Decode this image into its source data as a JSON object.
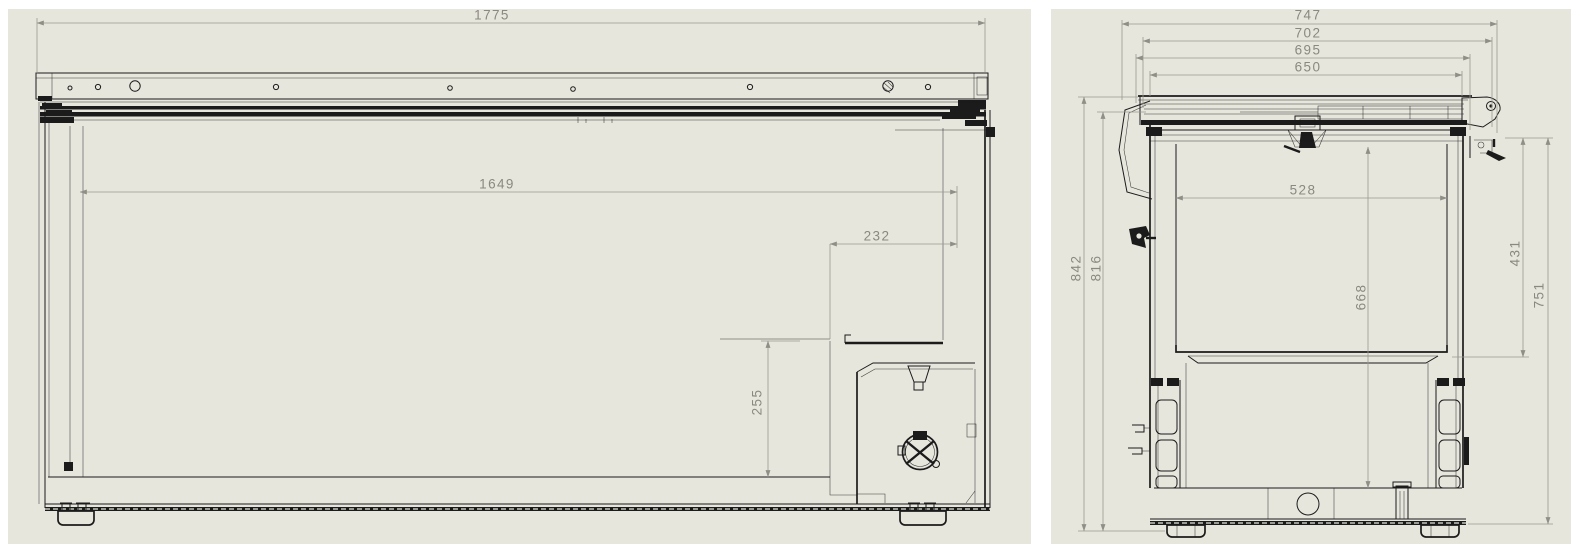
{
  "colors": {
    "page": "#ffffff",
    "panel": "#e7e6dd",
    "line": "#1b1b1b",
    "dim": "#9a998f",
    "dimtext": "#8a8981"
  },
  "views": {
    "front": {
      "dims": {
        "overall_width": "1775",
        "opening_width": "1649",
        "corner_step_width": "232",
        "corner_step_height": "255"
      }
    },
    "side": {
      "dims": {
        "overall_depth": "747",
        "depth_2": "702",
        "depth_3": "695",
        "depth_4": "650",
        "overall_height": "842",
        "height_2": "816",
        "opening_depth": "528",
        "interior_depth": "668",
        "upper_interior_height": "431",
        "right_height": "751"
      }
    }
  }
}
